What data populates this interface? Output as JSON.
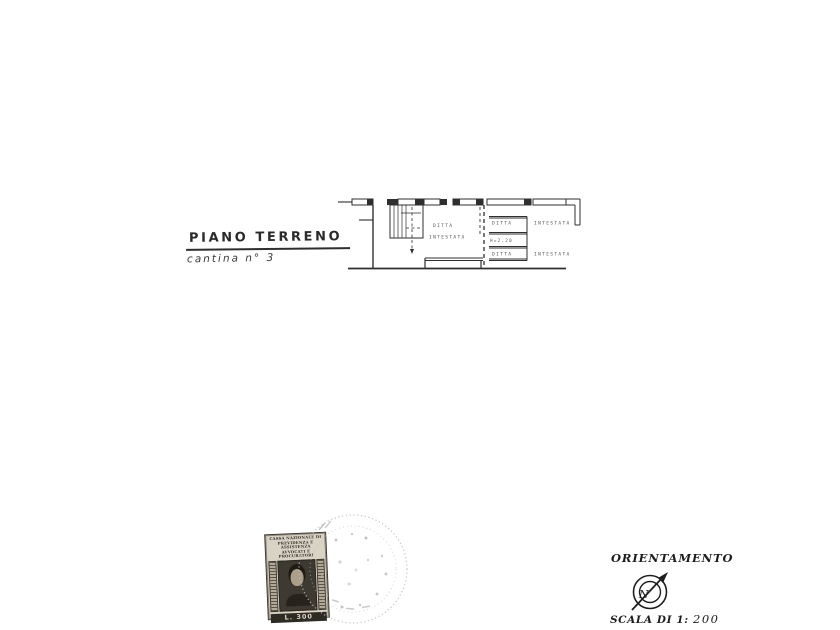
{
  "page": {
    "background": "#ffffff",
    "ink_color": "#2f2f2f"
  },
  "title_block": {
    "title": "PIANO TERRENO",
    "subtitle": "cantina n° 3"
  },
  "floor_plan": {
    "main_room": {
      "line1": "DITTA",
      "line2": "INTESTATA"
    },
    "right_room_top": {
      "word1": "DITTA",
      "word2": "INTESTATA"
    },
    "height_note": "H=2.20",
    "right_room_bottom": {
      "word1": "DITTA",
      "word2": "INTESTATA"
    }
  },
  "revenue_stamp": {
    "header_line1": "CASSA NAZIONALE DI",
    "header_line2": "PREVIDENZA E ASSISTENZA",
    "header_line3": "AVVOCATI E PROCURATORI",
    "value": "L. 300"
  },
  "orientation": {
    "label": "ORIENTAMENTO",
    "compass_letter": "N",
    "scale_prefix": "SCALA DI 1:",
    "scale_value": "200"
  }
}
